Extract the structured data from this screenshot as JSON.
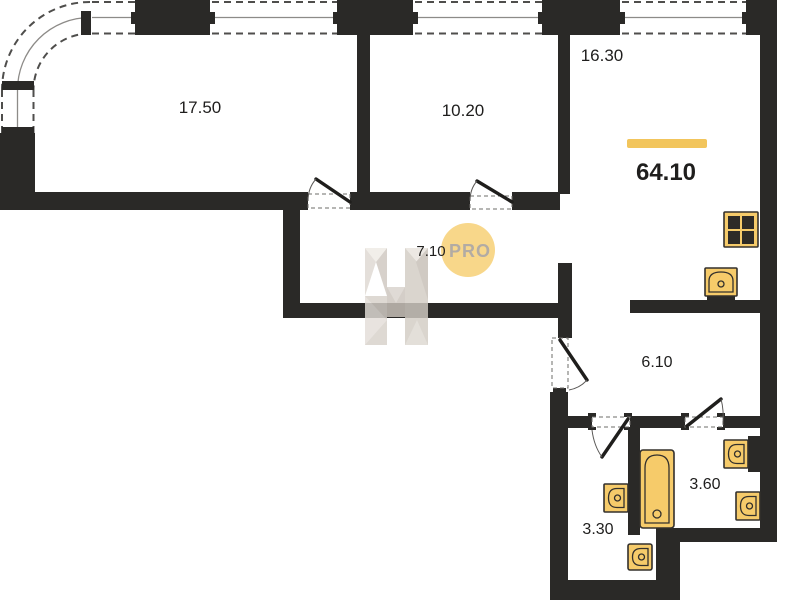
{
  "title": "Apartment floor plan",
  "total": {
    "area_label": "64.10"
  },
  "rooms": {
    "living": {
      "area_label": "17.50"
    },
    "bedroom": {
      "area_label": "10.20"
    },
    "kitchen_living": {
      "area_label": "16.30"
    },
    "hallway": {
      "area_label": "7.10"
    },
    "corridor": {
      "area_label": "6.10"
    },
    "bathroom_small": {
      "area_label": "3.30"
    },
    "bathroom_large": {
      "area_label": "3.60"
    }
  },
  "watermark": {
    "brand_text": "PRO"
  },
  "icons": {
    "stove": "stove-icon",
    "kitchen_sink": "kitchen-sink-icon",
    "bathtub": "bathtub-icon",
    "sinks": [
      "sink-icon",
      "sink-icon",
      "sink-icon"
    ],
    "toilet": "toilet-icon"
  },
  "colors": {
    "wall": "#2A2927",
    "background": "#FFFFFF",
    "fixture_fill": "#F6CB6A",
    "fixture_stroke": "#33302C",
    "accent_bar": "#F2C55C",
    "watermark_circle": "#F8D584",
    "watermark_text": "#B2ABA4",
    "logo_beige_light": "#E3DED8",
    "logo_beige_dark": "#C6BFB7"
  }
}
